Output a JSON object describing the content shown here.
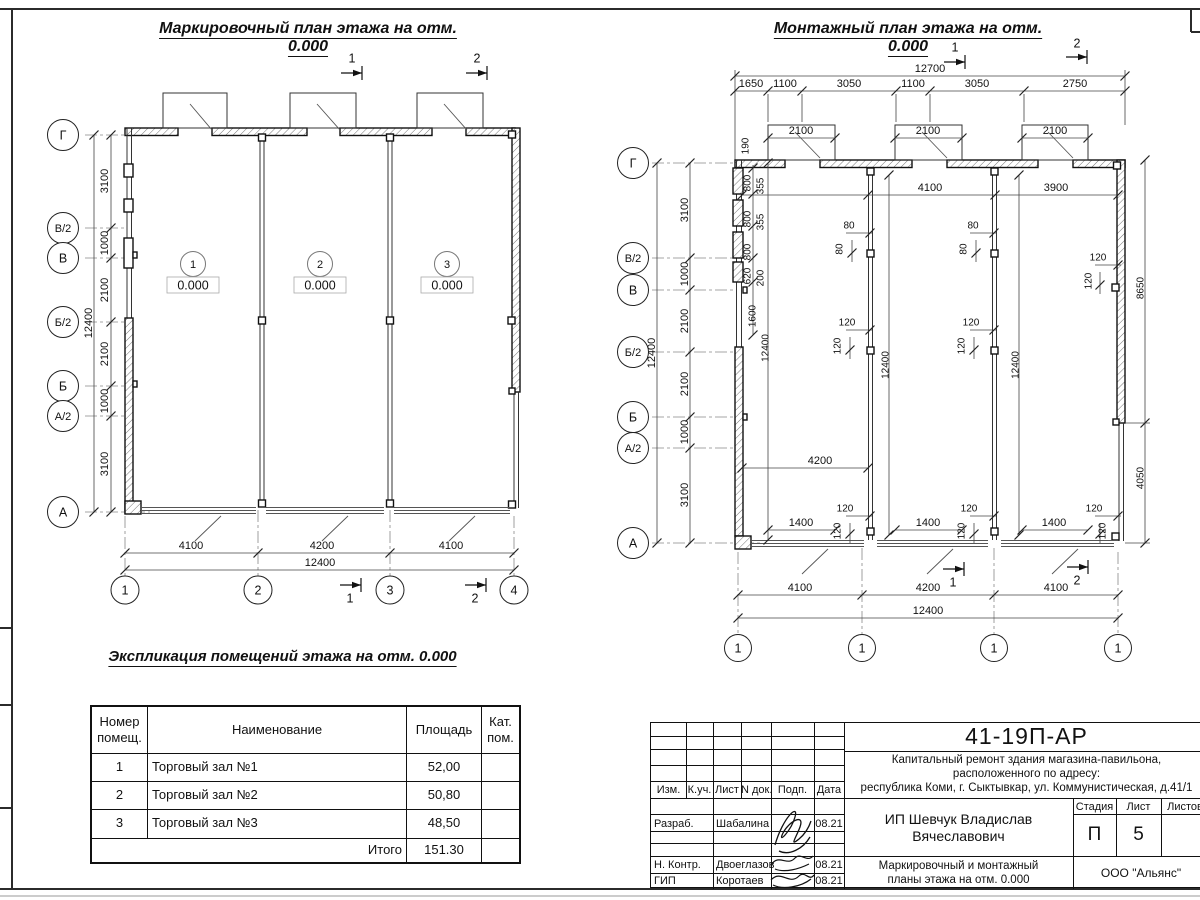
{
  "marking_plan": {
    "title": "Маркировочный план этажа на отм. 0.000",
    "section_marks_top": [
      "1",
      "2"
    ],
    "section_marks_bottom": [
      "1",
      "2"
    ],
    "row_axes": [
      "Г",
      "В/2",
      "В",
      "Б/2",
      "Б",
      "А/2",
      "А"
    ],
    "row_dims": [
      "3100",
      "1000",
      "2100",
      "2100",
      "1000",
      "3100"
    ],
    "row_total": "12400",
    "col_axes": [
      "1",
      "2",
      "3",
      "4"
    ],
    "col_dims": [
      "4100",
      "4200",
      "4100"
    ],
    "col_total": "12400",
    "rooms": [
      {
        "num": "1",
        "level": "0.000"
      },
      {
        "num": "2",
        "level": "0.000"
      },
      {
        "num": "3",
        "level": "0.000"
      }
    ]
  },
  "montage_plan": {
    "title": "Монтажный план этажа на отм. 0.000",
    "section_marks_top": [
      "1",
      "2"
    ],
    "section_marks_bottom": [
      "1",
      "2"
    ],
    "row_axes": [
      "Г",
      "В/2",
      "В",
      "Б/2",
      "Б",
      "А/2",
      "А"
    ],
    "row_dims": [
      "3100",
      "1000",
      "2100",
      "2100",
      "1000",
      "3100"
    ],
    "row_total": "12400",
    "top_total": "12700",
    "top_dims": [
      "1650",
      "1100",
      "3050",
      "1100",
      "3050",
      "2750"
    ],
    "door_dims": [
      "2100",
      "2100",
      "2100"
    ],
    "upper_inner_dims": [
      "4100",
      "3900"
    ],
    "left_wall": {
      "thickness": "190",
      "panels": [
        "800",
        "355",
        "800",
        "355",
        "800",
        "620",
        "200",
        "1600"
      ],
      "height": "12400"
    },
    "partitions": [
      {
        "top": [
          "80",
          "80"
        ],
        "mid": [
          "120",
          "120"
        ],
        "height": "12400",
        "bottom": [
          "120",
          "120"
        ]
      },
      {
        "top": [
          "80",
          "80"
        ],
        "mid": [
          "120",
          "120"
        ],
        "height": "12400",
        "bottom": [
          "120",
          "120"
        ]
      }
    ],
    "right_wall": {
      "upper": [
        "120",
        "120"
      ],
      "h_upper": "8650",
      "h_lower": "4050",
      "bottom": [
        "120",
        "120"
      ]
    },
    "mid_inner_dim": "4200",
    "opening_dims": [
      "1400",
      "1400",
      "1400"
    ],
    "col_dims": [
      "4100",
      "4200",
      "4100"
    ],
    "col_total": "12400",
    "col_axes": [
      "1",
      "1",
      "1",
      "1"
    ]
  },
  "explication": {
    "title": "Экспликация помещений этажа на отм. 0.000",
    "col_headers": [
      "Номер\nпомещ.",
      "Наименование",
      "Площадь",
      "Кат.\nпом."
    ],
    "rows": [
      {
        "num": "1",
        "name": "Торговый зал №1",
        "area": "52,00",
        "cat": ""
      },
      {
        "num": "2",
        "name": "Торговый зал №2",
        "area": "50,80",
        "cat": ""
      },
      {
        "num": "3",
        "name": "Торговый зал №3",
        "area": "48,50",
        "cat": ""
      }
    ],
    "total_label": "Итого",
    "total_value": "151.30"
  },
  "title_block": {
    "doc_number": "41-19П-АР",
    "project_lines": [
      "Капитальный ремонт здания магазина-павильона,",
      "расположенного по адресу:",
      "республика Коми, г. Сыктывкар, ул. Коммунистическая, д.41/1"
    ],
    "rev_headers": [
      "Изм.",
      "К.уч.",
      "Лист",
      "N док.",
      "Подп.",
      "Дата"
    ],
    "signers": [
      {
        "role": "Разраб.",
        "name": "Шабалина",
        "date": "08.21"
      },
      {
        "role": "Н. Контр.",
        "name": "Двоеглазов",
        "date": "08.21"
      },
      {
        "role": "ГИП",
        "name": "Коротаев",
        "date": "08.21"
      }
    ],
    "client_lines": [
      "ИП Шевчук Владислав",
      "Вячеславович"
    ],
    "stage_header": "Стадия",
    "sheet_header": "Лист",
    "sheets_header": "Листов",
    "stage": "П",
    "sheet_number": "5",
    "sheet_title_lines": [
      "Маркировочный и монтажный",
      "планы этажа на отм. 0.000"
    ],
    "company": "ООО \"Альянс\""
  }
}
